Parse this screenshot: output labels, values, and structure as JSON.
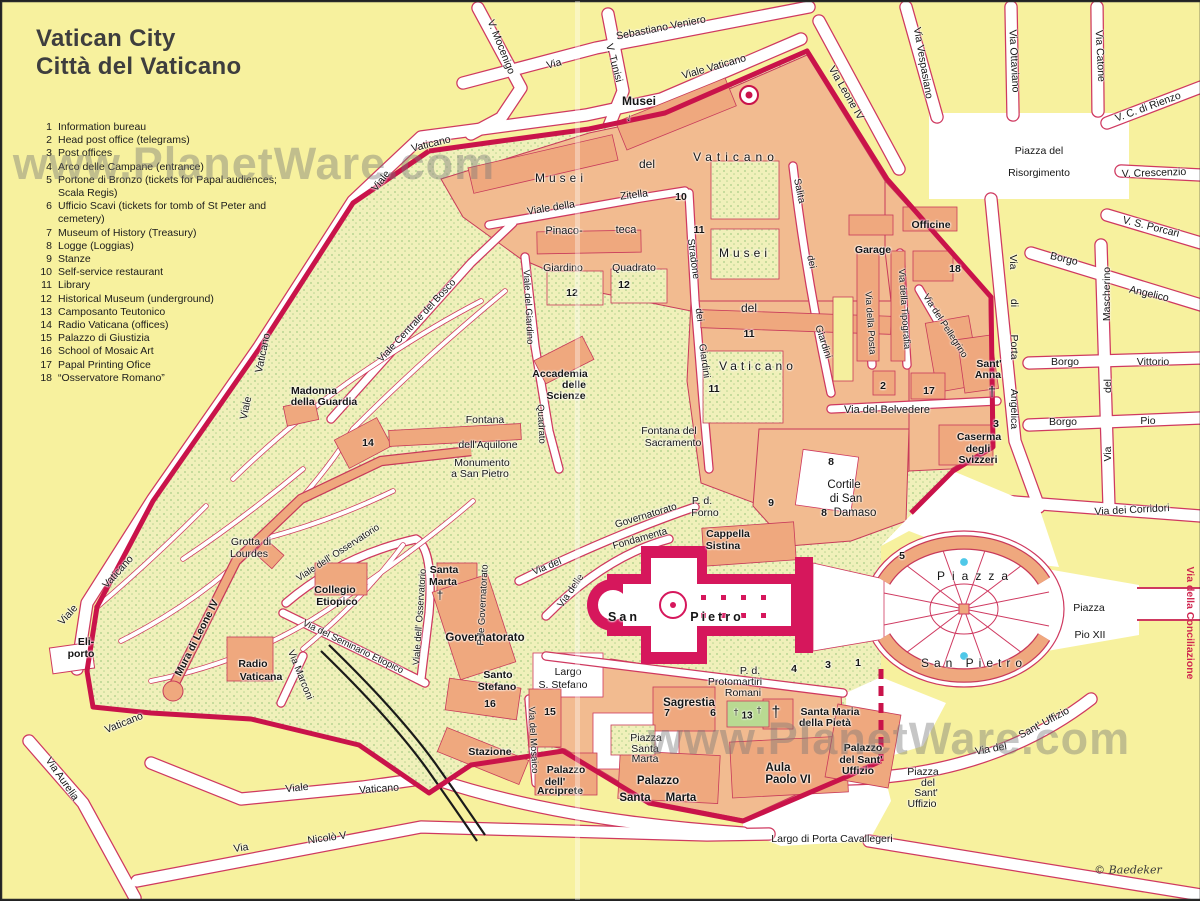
{
  "title": {
    "line1": "Vatican City",
    "line2": "Città del Vaticano"
  },
  "legend": {
    "items": [
      {
        "n": "1",
        "t": "Information bureau"
      },
      {
        "n": "2",
        "t": "Head post office (telegrams)"
      },
      {
        "n": "3",
        "t": "Post offices"
      },
      {
        "n": "4",
        "t": "Arco delle Campane (entrance)"
      },
      {
        "n": "5",
        "t": "Portone di Bronzo (tickets for Papal audiences; Scala Regis)"
      },
      {
        "n": "6",
        "t": "Ufficio Scavi (tickets for tomb of St Peter and cemetery)"
      },
      {
        "n": "7",
        "t": "Museum of History (Treasury)"
      },
      {
        "n": "8",
        "t": "Logge (Loggias)"
      },
      {
        "n": "9",
        "t": "Stanze"
      },
      {
        "n": "10",
        "t": "Self-service restaurant"
      },
      {
        "n": "11",
        "t": "Library"
      },
      {
        "n": "12",
        "t": "Historical Museum (underground)"
      },
      {
        "n": "13",
        "t": "Camposanto Teutonico"
      },
      {
        "n": "14",
        "t": "Radio Vaticana (offices)"
      },
      {
        "n": "15",
        "t": "Palazzo di Giustizia"
      },
      {
        "n": "16",
        "t": "School of Mosaic Art"
      },
      {
        "n": "17",
        "t": "Papal Printing Ofice"
      },
      {
        "n": "18",
        "t": "“Osservatore Romano”"
      }
    ]
  },
  "watermark": {
    "text": "www.PlanetWare.com"
  },
  "credit": "© Baedeker",
  "colors": {
    "block_yellow": "#f7f19e",
    "street_border": "#cf3960",
    "wall": "#c9134a",
    "building": "#efa87e",
    "garden": "#f0f0ba",
    "basilica": "#d6175c",
    "fountain": "#4fc8e8",
    "camposanto_green": "#b9da92",
    "conciliazione_text": "#cf2750"
  },
  "map": {
    "labels": [
      {
        "t": "V. Mocenigo",
        "x": 500,
        "y": 46,
        "r": 68
      },
      {
        "t": "Via",
        "x": 553,
        "y": 63,
        "r": -14
      },
      {
        "t": "Sebastiano Veniero",
        "x": 660,
        "y": 27,
        "r": -11
      },
      {
        "t": "V. Tunisi",
        "x": 613,
        "y": 62,
        "r": 75
      },
      {
        "t": "Viale Vaticano",
        "x": 713,
        "y": 66,
        "r": -16
      },
      {
        "t": "Via Leone IV",
        "x": 845,
        "y": 92,
        "r": 60
      },
      {
        "t": "Via Vespasiano",
        "x": 922,
        "y": 62,
        "r": 80
      },
      {
        "t": "Via Ottaviano",
        "x": 1013,
        "y": 60,
        "r": 87
      },
      {
        "t": "Via Catone",
        "x": 1099,
        "y": 55,
        "r": 87
      },
      {
        "t": "V. C. di Rienzo",
        "x": 1147,
        "y": 106,
        "r": -20
      },
      {
        "t": "Piazza del",
        "x": 1038,
        "y": 150
      },
      {
        "t": "Risorgimento",
        "x": 1038,
        "y": 172
      },
      {
        "t": "V. Crescenzio",
        "x": 1153,
        "y": 172,
        "r": -2
      },
      {
        "t": "V. S. Porcari",
        "x": 1150,
        "y": 226,
        "r": 14
      },
      {
        "t": "Borgo",
        "x": 1063,
        "y": 258,
        "r": 13
      },
      {
        "t": "Angelico",
        "x": 1148,
        "y": 293,
        "r": 13
      },
      {
        "t": "Mascherino",
        "x": 1106,
        "y": 293,
        "r": -90
      },
      {
        "t": "del",
        "x": 1107,
        "y": 385,
        "r": -90
      },
      {
        "t": "Via",
        "x": 1107,
        "y": 453,
        "r": -90
      },
      {
        "t": "Borgo",
        "x": 1064,
        "y": 361
      },
      {
        "t": "Vittorio",
        "x": 1152,
        "y": 361
      },
      {
        "t": "Borgo",
        "x": 1062,
        "y": 421
      },
      {
        "t": "Pio",
        "x": 1147,
        "y": 420
      },
      {
        "t": "Via",
        "x": 1012,
        "y": 261,
        "r": 90
      },
      {
        "t": "di",
        "x": 1013,
        "y": 302,
        "r": 90
      },
      {
        "t": "Porta",
        "x": 1013,
        "y": 346,
        "r": 90
      },
      {
        "t": "Angelica",
        "x": 1013,
        "y": 408,
        "r": 90
      },
      {
        "t": "Via dei Corridori",
        "x": 1131,
        "y": 509,
        "r": -3
      },
      {
        "t": "Via della Conciliazione",
        "x": 1189,
        "y": 622,
        "r": 90,
        "s": 10.5,
        "c": "red"
      },
      {
        "t": "Piazza",
        "x": 1088,
        "y": 607
      },
      {
        "t": "Pio XII",
        "x": 1089,
        "y": 634
      },
      {
        "t": "Via del",
        "x": 990,
        "y": 748,
        "r": -10
      },
      {
        "t": "Sant' Uffizio",
        "x": 1043,
        "y": 722,
        "r": -28
      },
      {
        "t": "Piazza",
        "x": 922,
        "y": 771
      },
      {
        "t": "del",
        "x": 927,
        "y": 782
      },
      {
        "t": "Sant'",
        "x": 925,
        "y": 792
      },
      {
        "t": "Uffizio",
        "x": 921,
        "y": 803
      },
      {
        "t": "Largo di Porta Cavallegeri",
        "x": 831,
        "y": 838
      },
      {
        "t": "Via Aurelia",
        "x": 61,
        "y": 778,
        "r": 55
      },
      {
        "t": "Viale",
        "x": 296,
        "y": 787,
        "r": -6
      },
      {
        "t": "Vaticano",
        "x": 378,
        "y": 788,
        "r": -4
      },
      {
        "t": "Via",
        "x": 240,
        "y": 847,
        "r": -8
      },
      {
        "t": "Nicolò V",
        "x": 326,
        "y": 837,
        "r": -8
      },
      {
        "t": "Vaticano",
        "x": 123,
        "y": 722,
        "r": -22
      },
      {
        "t": "Viale",
        "x": 67,
        "y": 614,
        "r": -48
      },
      {
        "t": "Vaticano",
        "x": 117,
        "y": 571,
        "r": -48
      },
      {
        "t": "Viale",
        "x": 380,
        "y": 180,
        "r": -52
      },
      {
        "t": "Vaticano",
        "x": 430,
        "y": 143,
        "r": -14
      },
      {
        "t": "Vaticano",
        "x": 262,
        "y": 352,
        "r": -78
      },
      {
        "t": "Viale",
        "x": 245,
        "y": 407,
        "r": -78
      },
      {
        "t": "Musei",
        "x": 638,
        "y": 100,
        "b": true,
        "s": 12
      },
      {
        "t": "↓",
        "x": 628,
        "y": 117,
        "b": true,
        "s": 11,
        "r": 15
      },
      {
        "t": "Musei",
        "x": 560,
        "y": 177,
        "s": 12,
        "ls": 4
      },
      {
        "t": "del",
        "x": 646,
        "y": 163,
        "s": 12
      },
      {
        "t": "Vaticano",
        "x": 735,
        "y": 156,
        "s": 12,
        "ls": 5
      },
      {
        "t": "Viale della",
        "x": 550,
        "y": 207,
        "r": -9
      },
      {
        "t": "Zitella",
        "x": 633,
        "y": 194,
        "r": -7
      },
      {
        "t": "Pinaco-",
        "x": 563,
        "y": 230,
        "s": 11
      },
      {
        "t": "teca",
        "x": 625,
        "y": 229,
        "s": 11
      },
      {
        "t": "10",
        "x": 680,
        "y": 196,
        "b": true
      },
      {
        "t": "11",
        "x": 698,
        "y": 229,
        "b": true
      },
      {
        "t": "Giardino",
        "x": 562,
        "y": 267
      },
      {
        "t": "Quadrato",
        "x": 633,
        "y": 267
      },
      {
        "t": "12",
        "x": 571,
        "y": 292,
        "b": true
      },
      {
        "t": "12",
        "x": 623,
        "y": 284,
        "b": true
      },
      {
        "t": "Stradone",
        "x": 692,
        "y": 258,
        "r": 82,
        "s": 10
      },
      {
        "t": "dei",
        "x": 698,
        "y": 314,
        "r": 82,
        "s": 10
      },
      {
        "t": "Giardini",
        "x": 703,
        "y": 360,
        "r": 82,
        "s": 10
      },
      {
        "t": "Salita",
        "x": 798,
        "y": 190,
        "r": 78,
        "s": 10
      },
      {
        "t": "dei",
        "x": 810,
        "y": 261,
        "r": 78,
        "s": 10
      },
      {
        "t": "Giardini",
        "x": 822,
        "y": 341,
        "r": 72,
        "s": 10
      },
      {
        "t": "Musei",
        "x": 744,
        "y": 252,
        "s": 12,
        "ls": 4
      },
      {
        "t": "del",
        "x": 748,
        "y": 307,
        "s": 12
      },
      {
        "t": "Vaticano",
        "x": 757,
        "y": 365,
        "s": 12,
        "ls": 4
      },
      {
        "t": "11",
        "x": 748,
        "y": 333,
        "b": true
      },
      {
        "t": "11",
        "x": 713,
        "y": 388,
        "b": true
      },
      {
        "t": "Accademia",
        "x": 559,
        "y": 373,
        "b": true
      },
      {
        "t": "delle",
        "x": 573,
        "y": 384,
        "b": true
      },
      {
        "t": "Scienze",
        "x": 565,
        "y": 395,
        "b": true
      },
      {
        "t": "Fontana del",
        "x": 668,
        "y": 430
      },
      {
        "t": "Sacramento",
        "x": 672,
        "y": 442
      },
      {
        "t": "Viale del Giardino",
        "x": 527,
        "y": 306,
        "r": 87,
        "s": 9.5
      },
      {
        "t": "Quadrato",
        "x": 540,
        "y": 423,
        "r": 87,
        "s": 9.5
      },
      {
        "t": "Madonna",
        "x": 313,
        "y": 390,
        "b": true
      },
      {
        "t": "della Guardia",
        "x": 323,
        "y": 401,
        "b": true
      },
      {
        "t": "14",
        "x": 367,
        "y": 442,
        "b": true
      },
      {
        "t": "Fontana",
        "x": 484,
        "y": 419
      },
      {
        "t": "dell'Aquilone",
        "x": 487,
        "y": 444
      },
      {
        "t": "Monumento",
        "x": 481,
        "y": 462
      },
      {
        "t": "a San Pietro",
        "x": 479,
        "y": 473
      },
      {
        "t": "Viale Centrale del Bosco",
        "x": 416,
        "y": 320,
        "r": -47,
        "s": 10
      },
      {
        "t": "Grotta di",
        "x": 250,
        "y": 541
      },
      {
        "t": "Lourdes",
        "x": 248,
        "y": 553
      },
      {
        "t": "Mura di Leone IV",
        "x": 196,
        "y": 637,
        "r": -63,
        "b": true,
        "s": 10.5
      },
      {
        "t": "Eli-",
        "x": 85,
        "y": 641,
        "b": true
      },
      {
        "t": "porto",
        "x": 80,
        "y": 653,
        "b": true
      },
      {
        "t": "Radio",
        "x": 252,
        "y": 663,
        "b": true
      },
      {
        "t": "Vaticana",
        "x": 260,
        "y": 676,
        "b": true
      },
      {
        "t": "Collegio",
        "x": 334,
        "y": 589,
        "b": true
      },
      {
        "t": "Etiopico",
        "x": 336,
        "y": 601,
        "b": true
      },
      {
        "t": "Viale dell' Osservatorio",
        "x": 337,
        "y": 552,
        "r": -33,
        "s": 9.5
      },
      {
        "t": "Viale dell' Osservatorio",
        "x": 419,
        "y": 616,
        "r": -86,
        "s": 9.5
      },
      {
        "t": "Via del Seminario Etiopico",
        "x": 352,
        "y": 646,
        "r": 26,
        "s": 9.5
      },
      {
        "t": "Via Marconi",
        "x": 299,
        "y": 674,
        "r": 68,
        "s": 10
      },
      {
        "t": "Santa",
        "x": 443,
        "y": 569,
        "b": true
      },
      {
        "t": "Marta",
        "x": 442,
        "y": 581,
        "b": true
      },
      {
        "t": "†",
        "x": 439,
        "y": 594,
        "s": 12
      },
      {
        "t": "Governatorato",
        "x": 484,
        "y": 637,
        "b": true,
        "s": 11.5
      },
      {
        "t": "P. le Governatorato",
        "x": 482,
        "y": 604,
        "r": -87,
        "s": 9.5
      },
      {
        "t": "Via del",
        "x": 546,
        "y": 566,
        "r": -22,
        "s": 10
      },
      {
        "t": "Governatorato",
        "x": 645,
        "y": 515,
        "r": -17,
        "s": 10
      },
      {
        "t": "Fondamenta",
        "x": 639,
        "y": 538,
        "r": -16,
        "s": 10
      },
      {
        "t": "Via delle",
        "x": 570,
        "y": 590,
        "r": -55,
        "s": 10
      },
      {
        "t": "P. d.",
        "x": 701,
        "y": 500
      },
      {
        "t": "Forno",
        "x": 704,
        "y": 512
      },
      {
        "t": "Cappella",
        "x": 727,
        "y": 533,
        "b": true
      },
      {
        "t": "Sistina",
        "x": 722,
        "y": 545,
        "b": true
      },
      {
        "t": "9",
        "x": 770,
        "y": 502,
        "b": true
      },
      {
        "t": "8",
        "x": 830,
        "y": 461,
        "b": true
      },
      {
        "t": "8",
        "x": 823,
        "y": 512,
        "b": true
      },
      {
        "t": "Cortile",
        "x": 843,
        "y": 484,
        "s": 11.5
      },
      {
        "t": "di San",
        "x": 845,
        "y": 498,
        "s": 11.5
      },
      {
        "t": "Damaso",
        "x": 854,
        "y": 512,
        "s": 11.5
      },
      {
        "t": "Via del Belvedere",
        "x": 886,
        "y": 409,
        "s": 11
      },
      {
        "t": "Caserma",
        "x": 978,
        "y": 436,
        "b": true
      },
      {
        "t": "degli",
        "x": 977,
        "y": 448,
        "b": true
      },
      {
        "t": "Svizzeri",
        "x": 977,
        "y": 459,
        "b": true
      },
      {
        "t": "3",
        "x": 995,
        "y": 423,
        "b": true
      },
      {
        "t": "Officine",
        "x": 930,
        "y": 224,
        "b": true
      },
      {
        "t": "Garage",
        "x": 872,
        "y": 249,
        "b": true
      },
      {
        "t": "Via della Posta",
        "x": 869,
        "y": 322,
        "r": 86,
        "s": 9.5
      },
      {
        "t": "Via della Tipografia",
        "x": 903,
        "y": 308,
        "r": 86,
        "s": 9.5
      },
      {
        "t": "Via del Pellegrino",
        "x": 944,
        "y": 325,
        "r": 57,
        "s": 9.5
      },
      {
        "t": "18",
        "x": 954,
        "y": 268,
        "b": true
      },
      {
        "t": "2",
        "x": 882,
        "y": 385,
        "b": true
      },
      {
        "t": "17",
        "x": 928,
        "y": 390,
        "b": true
      },
      {
        "t": "Sant'",
        "x": 988,
        "y": 363,
        "b": true
      },
      {
        "t": "Anna",
        "x": 987,
        "y": 374,
        "b": true
      },
      {
        "t": "†",
        "x": 991,
        "y": 390,
        "s": 14
      },
      {
        "t": "San",
        "x": 623,
        "y": 616,
        "b": true,
        "s": 12.5,
        "ls": 3
      },
      {
        "t": "Pietro",
        "x": 716,
        "y": 616,
        "b": true,
        "s": 12.5,
        "ls": 3
      },
      {
        "t": "P. d.",
        "x": 749,
        "y": 670
      },
      {
        "t": "Protomartiri",
        "x": 734,
        "y": 681
      },
      {
        "t": "Romani",
        "x": 742,
        "y": 692
      },
      {
        "t": "Sagrestia",
        "x": 688,
        "y": 702,
        "b": true,
        "s": 11.5
      },
      {
        "t": "7",
        "x": 666,
        "y": 712,
        "b": true
      },
      {
        "t": "6",
        "x": 712,
        "y": 712,
        "b": true
      },
      {
        "t": "Piazza",
        "x": 645,
        "y": 737
      },
      {
        "t": "Santa",
        "x": 644,
        "y": 748
      },
      {
        "t": "Marta",
        "x": 644,
        "y": 758
      },
      {
        "t": "Palazzo",
        "x": 657,
        "y": 780,
        "b": true,
        "s": 11.5
      },
      {
        "t": "Santa",
        "x": 634,
        "y": 797,
        "b": true,
        "s": 11.5
      },
      {
        "t": "Marta",
        "x": 680,
        "y": 797,
        "b": true,
        "s": 11.5
      },
      {
        "t": "†",
        "x": 735,
        "y": 711,
        "s": 9
      },
      {
        "t": "13",
        "x": 746,
        "y": 715,
        "b": true,
        "s": 10
      },
      {
        "t": "†",
        "x": 758,
        "y": 709,
        "s": 9
      },
      {
        "t": "†",
        "x": 775,
        "y": 712,
        "s": 16
      },
      {
        "t": "Santa Maria",
        "x": 829,
        "y": 711,
        "b": true
      },
      {
        "t": "della Pietà",
        "x": 824,
        "y": 722,
        "b": true
      },
      {
        "t": "Aula",
        "x": 777,
        "y": 767,
        "b": true,
        "s": 11.5
      },
      {
        "t": "Paolo VI",
        "x": 787,
        "y": 779,
        "b": true,
        "s": 11.5
      },
      {
        "t": "Palazzo",
        "x": 862,
        "y": 747,
        "b": true
      },
      {
        "t": "del Sant'",
        "x": 860,
        "y": 759,
        "b": true
      },
      {
        "t": "Uffizio",
        "x": 857,
        "y": 770,
        "b": true
      },
      {
        "t": "4",
        "x": 793,
        "y": 668,
        "b": true
      },
      {
        "t": "3",
        "x": 827,
        "y": 664,
        "b": true
      },
      {
        "t": "1",
        "x": 857,
        "y": 662,
        "b": true
      },
      {
        "t": "5",
        "x": 901,
        "y": 555,
        "b": true
      },
      {
        "t": "Piazza",
        "x": 975,
        "y": 575,
        "s": 12,
        "ls": 7
      },
      {
        "t": "San Pietro",
        "x": 973,
        "y": 662,
        "s": 12,
        "ls": 5
      },
      {
        "t": "Santo",
        "x": 497,
        "y": 674,
        "b": true
      },
      {
        "t": "Stefano",
        "x": 496,
        "y": 686,
        "b": true
      },
      {
        "t": "Largo",
        "x": 567,
        "y": 671
      },
      {
        "t": "S. Stefano",
        "x": 562,
        "y": 684
      },
      {
        "t": "16",
        "x": 489,
        "y": 703,
        "b": true
      },
      {
        "t": "15",
        "x": 549,
        "y": 711,
        "b": true
      },
      {
        "t": "Stazione",
        "x": 489,
        "y": 751,
        "b": true
      },
      {
        "t": "Via del Mosaico",
        "x": 532,
        "y": 739,
        "r": 87,
        "s": 9.5
      },
      {
        "t": "Palazzo",
        "x": 565,
        "y": 769,
        "b": true
      },
      {
        "t": "dell'",
        "x": 554,
        "y": 781,
        "b": true
      },
      {
        "t": "Arciprete",
        "x": 559,
        "y": 790,
        "b": true
      }
    ]
  }
}
